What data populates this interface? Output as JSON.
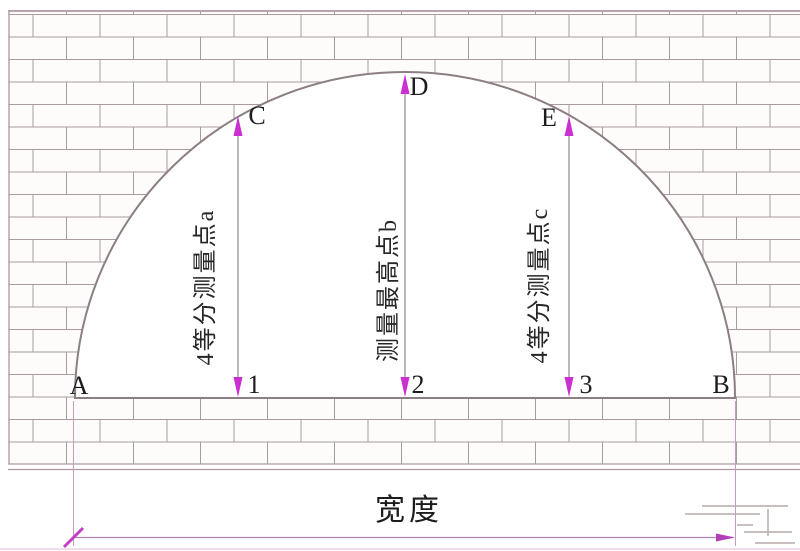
{
  "diagram": {
    "type": "arch-width-measurement",
    "points": {
      "A": "A",
      "B": "B",
      "C": "C",
      "D": "D",
      "E": "E",
      "n1": "1",
      "n2": "2",
      "n3": "3"
    },
    "annotations": {
      "left": "4等分测量点a",
      "middle": "测量最高点b",
      "right": "4等分测量点c"
    },
    "width_label": "宽度",
    "colors": {
      "arrow_magenta": "#cb2ed1",
      "dimension_magenta": "#b455b8",
      "tick_magenta": "#c23fc2",
      "outline_gray": "#8c7f82",
      "brick_mortar": "#a99c9e",
      "label_text": "#1c1c1c"
    }
  }
}
